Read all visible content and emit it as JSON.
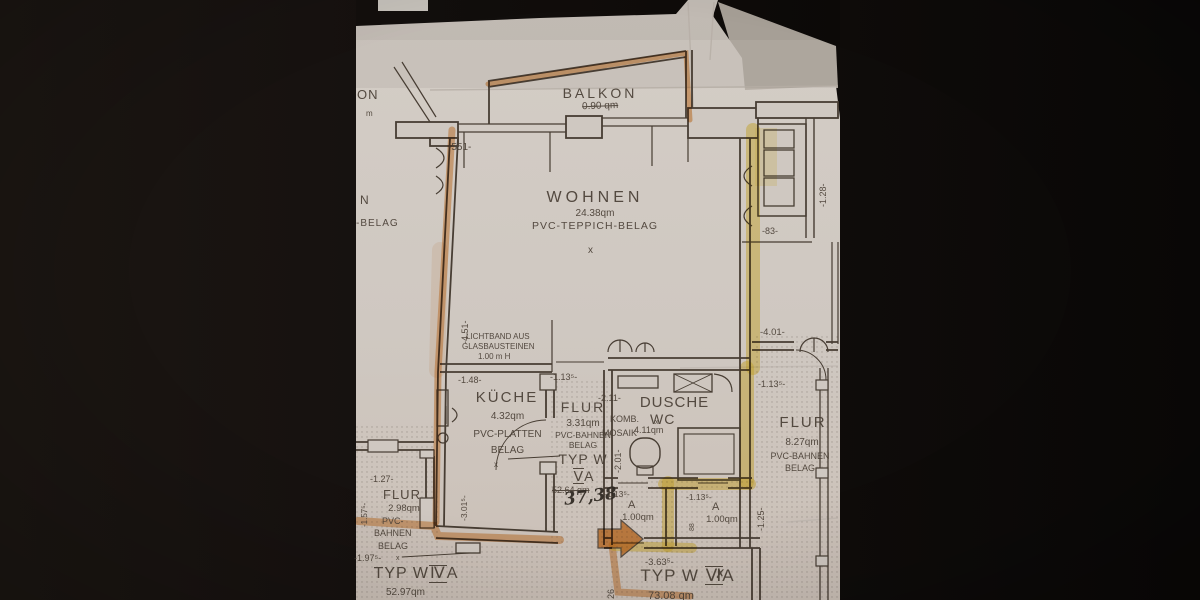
{
  "colors": {
    "paper": "#cfc8c1",
    "ink": "#473d33",
    "highlight_orange": "#e0862e",
    "highlight_yellow": "#f0d040"
  },
  "rooms": {
    "balkon": {
      "label": "BALKON",
      "area_struck": "0.90 qm"
    },
    "wohnen": {
      "label": "WOHNEN",
      "area": "24.38qm",
      "floor": "PVC-TEPPICH-BELAG"
    },
    "kueche": {
      "label": "KÜCHE",
      "area": "4.32qm",
      "floor_1": "PVC-PLATTEN",
      "floor_2": "BELAG"
    },
    "flur_mitte": {
      "label": "FLUR",
      "area": "3.31qm",
      "floor_1": "PVC-BAHNEN",
      "floor_2": "BELAG"
    },
    "dusche": {
      "label": "DUSCHE",
      "sub_1": "KOMB.",
      "sub_2": "WC",
      "sub_3": "MOSAIK",
      "area": "4.11qm"
    },
    "flur_rechts": {
      "label": "FLUR",
      "area": "8.27qm",
      "floor_1": "PVC-BAHNEN",
      "floor_2": "BELAG"
    },
    "flur_links": {
      "label": "FLUR",
      "area": "2.98qm",
      "floor_1": "PVC-",
      "floor_2": "BAHNEN",
      "floor_3": "BELAG"
    },
    "abstell_1": {
      "label": "A",
      "area": "1.00qm"
    },
    "abstell_2": {
      "label": "A",
      "area": "1.00qm"
    }
  },
  "unit_types": {
    "va": {
      "prefix": "TYP W",
      "roman": "Ⅴ",
      "suffix": "A",
      "area_struck": "52.64 qm",
      "area_hand": "37,38"
    },
    "via": {
      "prefix": "TYP W",
      "roman": "Ⅵ",
      "mark": "✗",
      "suffix": "A",
      "area": "73.08 qm"
    },
    "iva": {
      "prefix": "TYP W",
      "roman": "Ⅳ",
      "suffix": "A",
      "area": "52.97qm"
    }
  },
  "annotations": {
    "lichtband_1": "LICHTBAND AUS",
    "lichtband_2": "GLASBAUSTEINEN",
    "lichtband_3": "1.00 m H",
    "partial_on": "ON",
    "partial_m": "m",
    "partial_n": "N",
    "partial_belag": "-BELAG",
    "x": "x"
  },
  "dims": {
    "d551": "-551-",
    "d148": "-1.48-",
    "d451": "-4.51-",
    "d3015": "-3.01⁵-",
    "d1135_flur": "-1.13⁵-",
    "d211": "-2.11-",
    "d201": "-2.01-",
    "d83": "-83-",
    "d128": "-1.28-",
    "d401": "-4.01-",
    "d1135_r": "-1.13⁵-",
    "d125": "-1.25-",
    "d1135_a1": "-1.13⁵-",
    "d1135_a2": "-1.13⁵-",
    "d88": "88",
    "d3635": "-3.63⁵-",
    "d126": "26",
    "d127": "-1.27-",
    "d1975": "-1.97⁵-",
    "d1575": "-1.57⁵-"
  }
}
